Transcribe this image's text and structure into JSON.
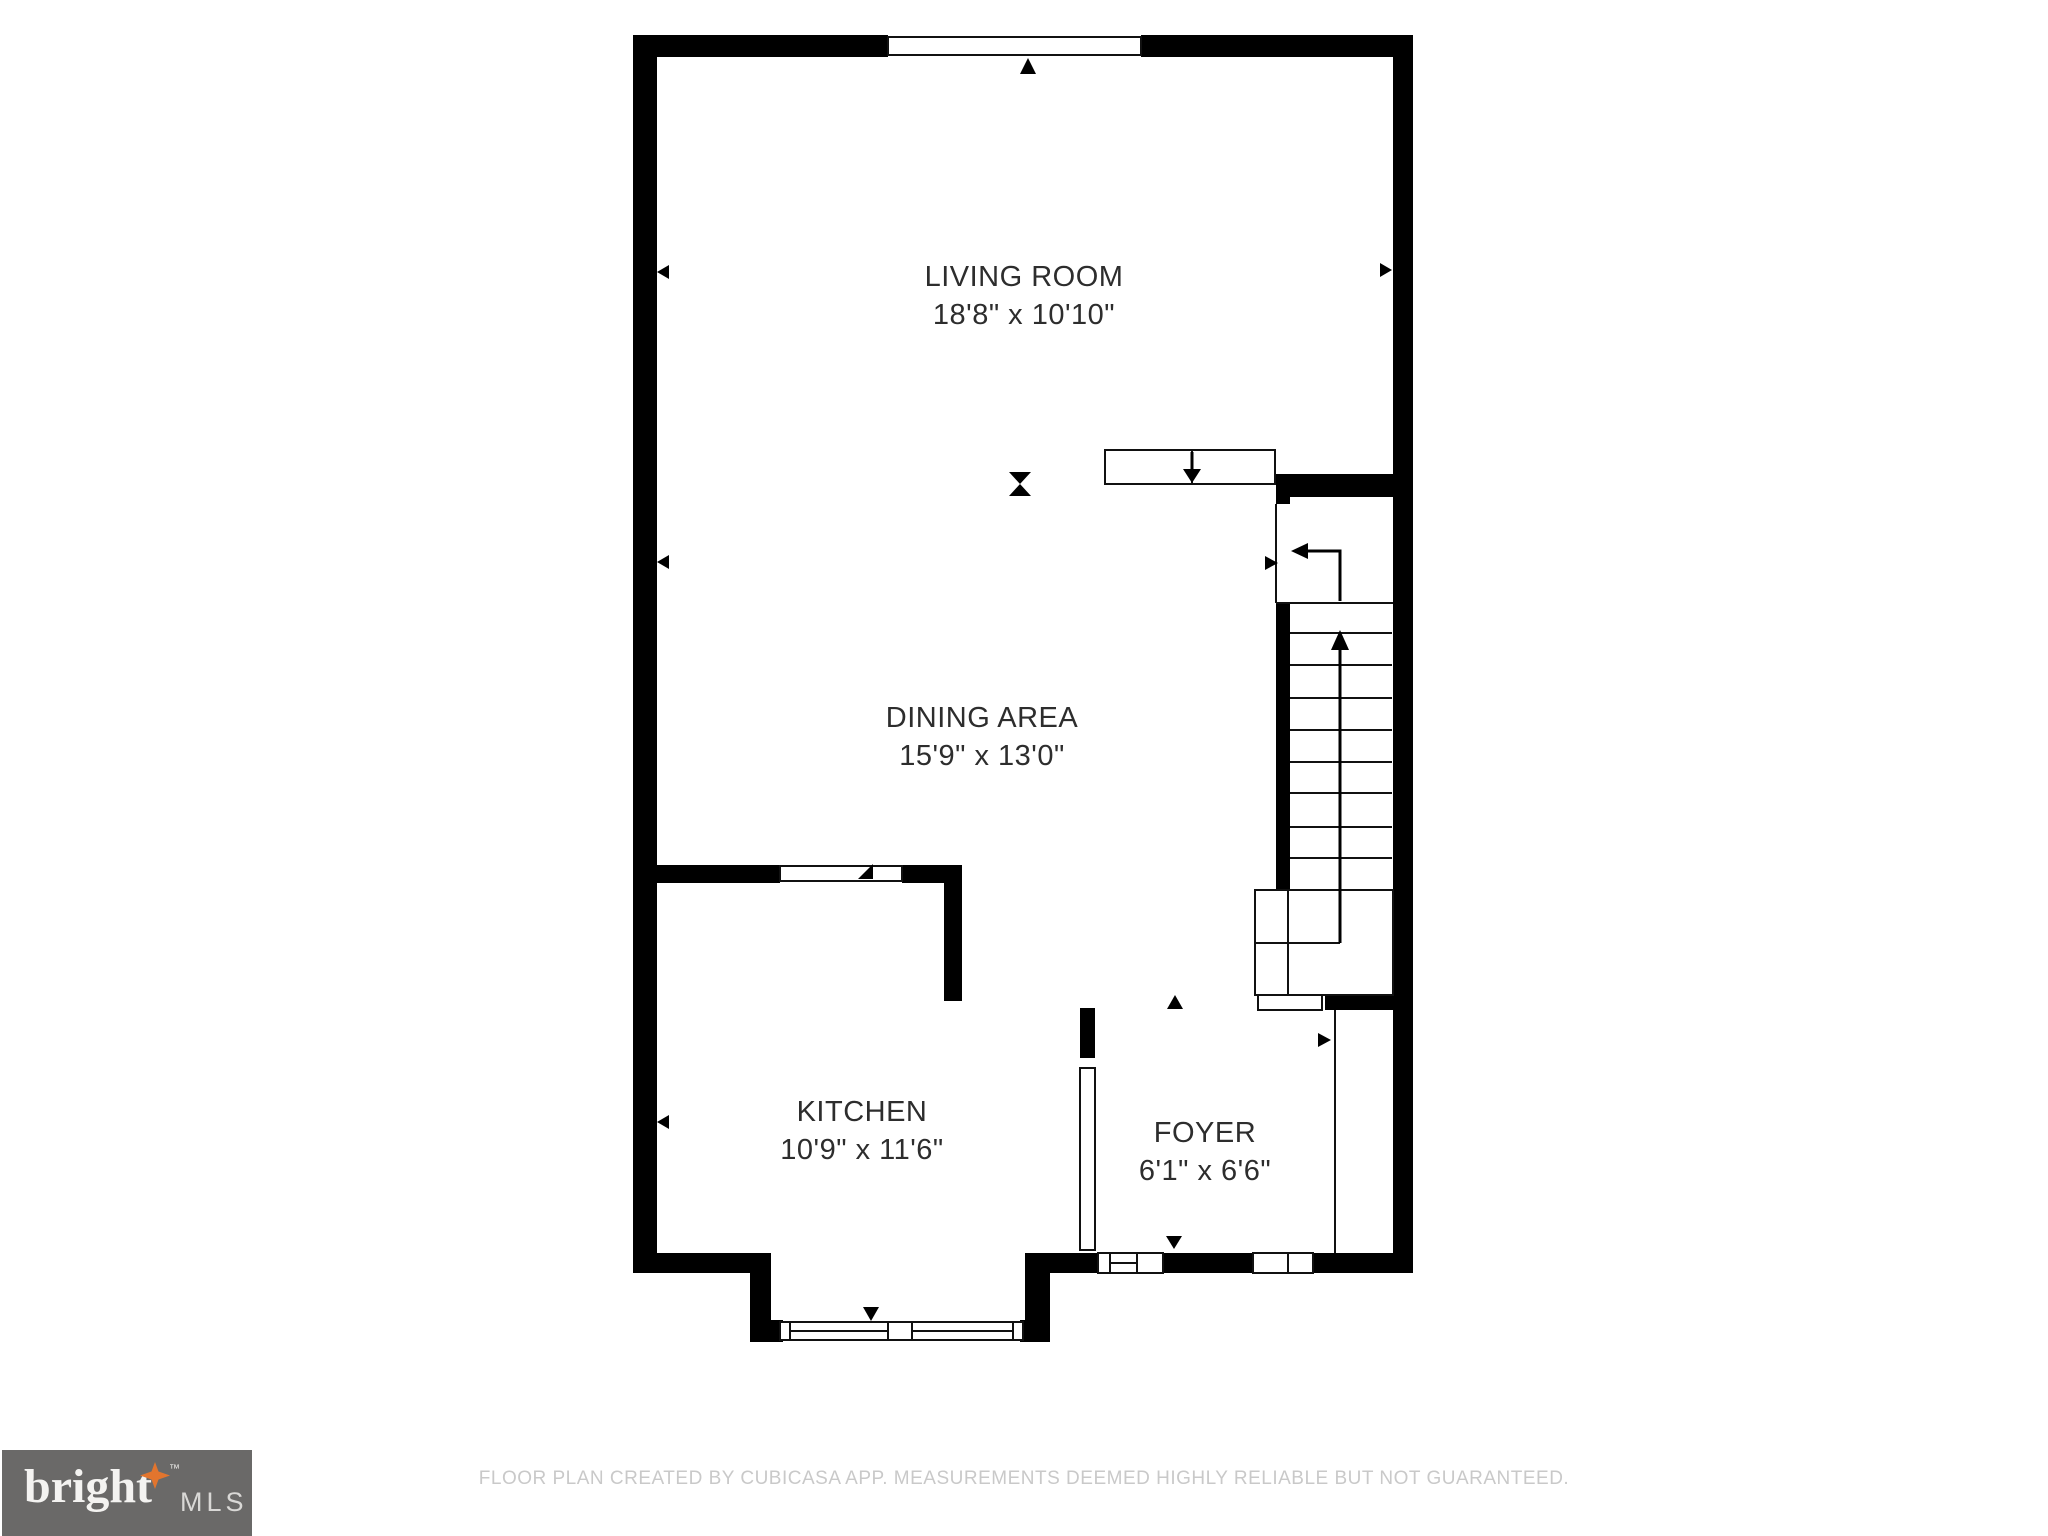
{
  "floor_plan": {
    "rooms": [
      {
        "name": "LIVING ROOM",
        "dimensions": "18'8\" x 10'10\""
      },
      {
        "name": "DINING AREA",
        "dimensions": "15'9\" x 13'0\""
      },
      {
        "name": "KITCHEN",
        "dimensions": "10'9\" x 11'6\""
      },
      {
        "name": "FOYER",
        "dimensions": "6'1\" x 6'6\""
      }
    ],
    "markers": [
      "window-direction-arrow-icon",
      "door-direction-arrow-icon",
      "stairs-up-arrow-icon",
      "stairs-down-arrow-icon",
      "hourglass-marker-icon"
    ]
  },
  "footer": {
    "disclaimer": "FLOOR PLAN CREATED BY CUBICASA APP. MEASUREMENTS DEEMED HIGHLY RELIABLE BUT NOT GUARANTEED."
  },
  "logo": {
    "brand": "bright",
    "trademark": "TM",
    "suffix": "MLS"
  },
  "colors": {
    "wall": "#000000",
    "background": "#ffffff",
    "footer_text": "#c9c9c9",
    "logo_background": "#6a6968",
    "logo_star": "#e2752e",
    "label_text": "#2d2d2d"
  }
}
